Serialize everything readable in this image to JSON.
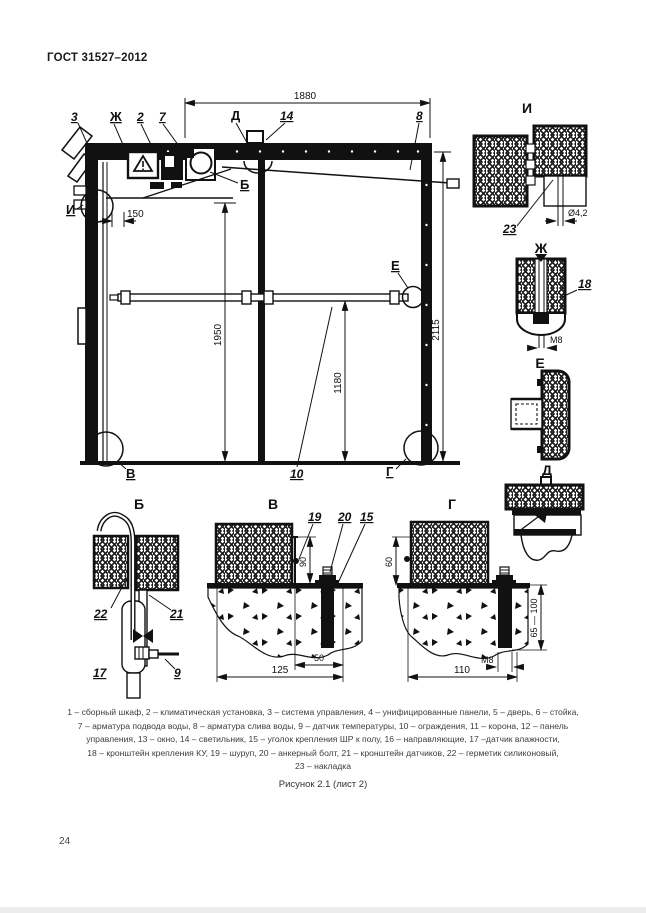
{
  "page": {
    "header": "ГОСТ 31527–2012",
    "page_number": "24",
    "figure_caption": "Рисунок 2.1 (лист 2)",
    "legend_lines": [
      "1 – сборный шкаф, 2 – климатическая установка, 3 – система управления, 4 – унифицированные панели, 5 – дверь, 6 – стойка,",
      "7 – арматура подвода воды, 8 – арматура слива воды, 9 – датчик температуры, 10 – ограждения, 11 – корона, 12 – панель",
      "управления, 13 – окно, 14 – светильник, 15 – уголок крепления ШР к полу, 16 – направляющие, 17 –датчик влажности,",
      "18 – кронштейн крепления КУ, 19 – шуруп, 20 – анкерный болт, 21 – кронштейн датчиков, 22 – герметик силиконовый,",
      "23 – накладка"
    ]
  },
  "main_view": {
    "callouts": {
      "c3": "3",
      "zh": "Ж",
      "c2": "2",
      "c7": "7",
      "d": "Д",
      "c14": "14",
      "c8": "8",
      "i": "И",
      "b": "Б",
      "e": "Е",
      "v": "В",
      "c10": "10",
      "g": "Г"
    },
    "dims": {
      "w1880": "1880",
      "h2115": "2115",
      "h1950": "1950",
      "h1180": "1180",
      "off150": "150"
    }
  },
  "details": {
    "i": {
      "title": "И",
      "c23": "23",
      "dia": "Ø4,2"
    },
    "zh": {
      "title": "Ж",
      "c18": "18",
      "m8": "М8"
    },
    "e": {
      "title": "Е"
    },
    "d": {
      "title": "Д"
    },
    "b": {
      "title": "Б",
      "c22": "22",
      "c21": "21",
      "c17": "17",
      "c9": "9"
    },
    "v": {
      "title": "В",
      "c19": "19",
      "c20": "20",
      "c15": "15",
      "d90": "90",
      "d50": "50",
      "d125": "125"
    },
    "g": {
      "title": "Г",
      "d60": "60",
      "d65_100": "65 — 100",
      "m8": "М8",
      "d110": "110"
    }
  }
}
